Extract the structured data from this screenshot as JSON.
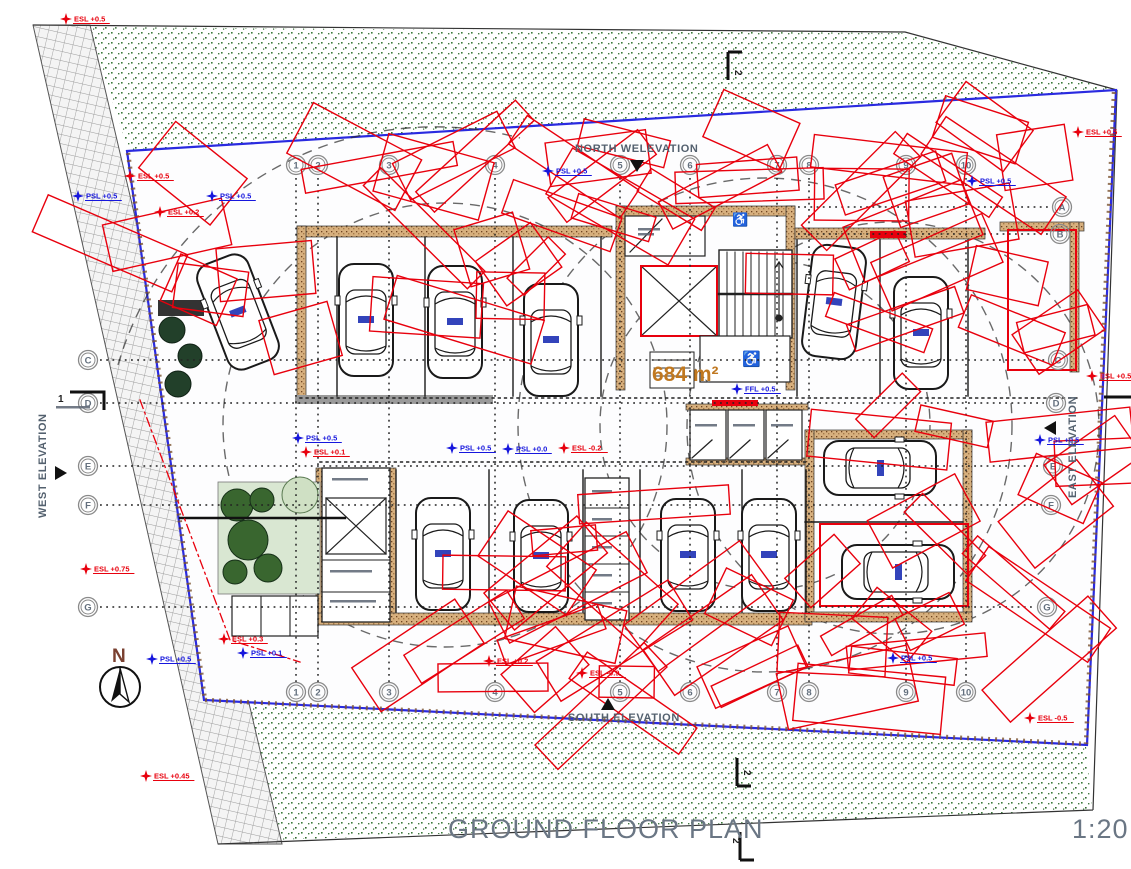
{
  "drawing": {
    "title": "GROUND FLOOR PLAN",
    "scale": "1:20",
    "area_label": "684 m²",
    "compass": "N"
  },
  "elevation_labels": {
    "north": "NORTH WELEVATION",
    "south": "SOUTH ELEVATION",
    "west": "WEST ELEVATION",
    "east": "EAST ELEVATION"
  },
  "grid": {
    "columns": [
      {
        "label": "1",
        "x": 296
      },
      {
        "label": "2",
        "x": 318
      },
      {
        "label": "3",
        "x": 389
      },
      {
        "label": "4",
        "x": 495
      },
      {
        "label": "5",
        "x": 620
      },
      {
        "label": "6",
        "x": 690
      },
      {
        "label": "7",
        "x": 777
      },
      {
        "label": "8",
        "x": 809
      },
      {
        "label": "9",
        "x": 906
      },
      {
        "label": "10",
        "x": 966
      }
    ],
    "rows": [
      {
        "label": "A",
        "y": 207,
        "left": false,
        "xr": 1062,
        "x_start": 798
      },
      {
        "label": "B",
        "y": 234,
        "left": false,
        "xr": 1060,
        "x_start": 798
      },
      {
        "label": "C",
        "y": 360,
        "left": true,
        "xr": 1058,
        "x_start": 100
      },
      {
        "label": "D",
        "y": 403,
        "left": true,
        "xr": 1056,
        "x_start": 100
      },
      {
        "label": "E",
        "y": 466,
        "left": true,
        "xr": 1053,
        "x_start": 100
      },
      {
        "label": "F",
        "y": 505,
        "left": true,
        "xr": 1051,
        "x_start": 100
      },
      {
        "label": "G",
        "y": 607,
        "left": true,
        "xr": 1047,
        "x_start": 100
      }
    ]
  },
  "section_markers": {
    "top": "2",
    "bottom": "2",
    "title_mark": "2",
    "left": "1"
  },
  "spot_levels": [
    {
      "text": "ESL +0.5",
      "type": "existing",
      "x": 66,
      "y": 19
    },
    {
      "text": "ESL +0.5",
      "type": "existing",
      "x": 130,
      "y": 176
    },
    {
      "text": "PSL +0.5",
      "type": "proposed",
      "x": 78,
      "y": 196
    },
    {
      "text": "PSL +0.5",
      "type": "proposed",
      "x": 212,
      "y": 196
    },
    {
      "text": "ESL +0.2",
      "type": "existing",
      "x": 160,
      "y": 212
    },
    {
      "text": "PSL +0.5",
      "type": "proposed",
      "x": 548,
      "y": 171
    },
    {
      "text": "ESL +0.5",
      "type": "existing",
      "x": 1078,
      "y": 132
    },
    {
      "text": "PSL +0.5",
      "type": "proposed",
      "x": 972,
      "y": 181
    },
    {
      "text": "ESL +0.5",
      "type": "existing",
      "x": 1092,
      "y": 376
    },
    {
      "text": "PSL +0.5",
      "type": "proposed",
      "x": 1040,
      "y": 440
    },
    {
      "text": "PSL +0.5",
      "type": "proposed",
      "x": 452,
      "y": 448
    },
    {
      "text": "PSL +0.0",
      "type": "proposed",
      "x": 508,
      "y": 449
    },
    {
      "text": "ESL -0.2",
      "type": "existing",
      "x": 564,
      "y": 448
    },
    {
      "text": "PSL +0.5",
      "type": "proposed",
      "x": 298,
      "y": 438
    },
    {
      "text": "ESL +0.1",
      "type": "existing",
      "x": 306,
      "y": 452
    },
    {
      "text": "FFL +0.5",
      "type": "proposed",
      "x": 737,
      "y": 389
    },
    {
      "text": "ESL +0.75",
      "type": "existing",
      "x": 86,
      "y": 569
    },
    {
      "text": "ESL +0.45",
      "type": "existing",
      "x": 146,
      "y": 776
    },
    {
      "text": "PSL +0.5",
      "type": "proposed",
      "x": 152,
      "y": 659
    },
    {
      "text": "ESL +0.3",
      "type": "existing",
      "x": 224,
      "y": 639
    },
    {
      "text": "PSL +0.1",
      "type": "proposed",
      "x": 243,
      "y": 653
    },
    {
      "text": "ESL -0.9",
      "type": "existing",
      "x": 582,
      "y": 673
    },
    {
      "text": "ESL +0.2",
      "type": "existing",
      "x": 489,
      "y": 661
    },
    {
      "text": "ESL -0.5",
      "type": "existing",
      "x": 1030,
      "y": 718
    },
    {
      "text": "PSL +0.5",
      "type": "proposed",
      "x": 893,
      "y": 658
    }
  ],
  "colors": {
    "existing_level": "#e8000d",
    "proposed_level": "#1616dd",
    "boundary": "#2a2ae0",
    "cloud": "#e8000d"
  }
}
